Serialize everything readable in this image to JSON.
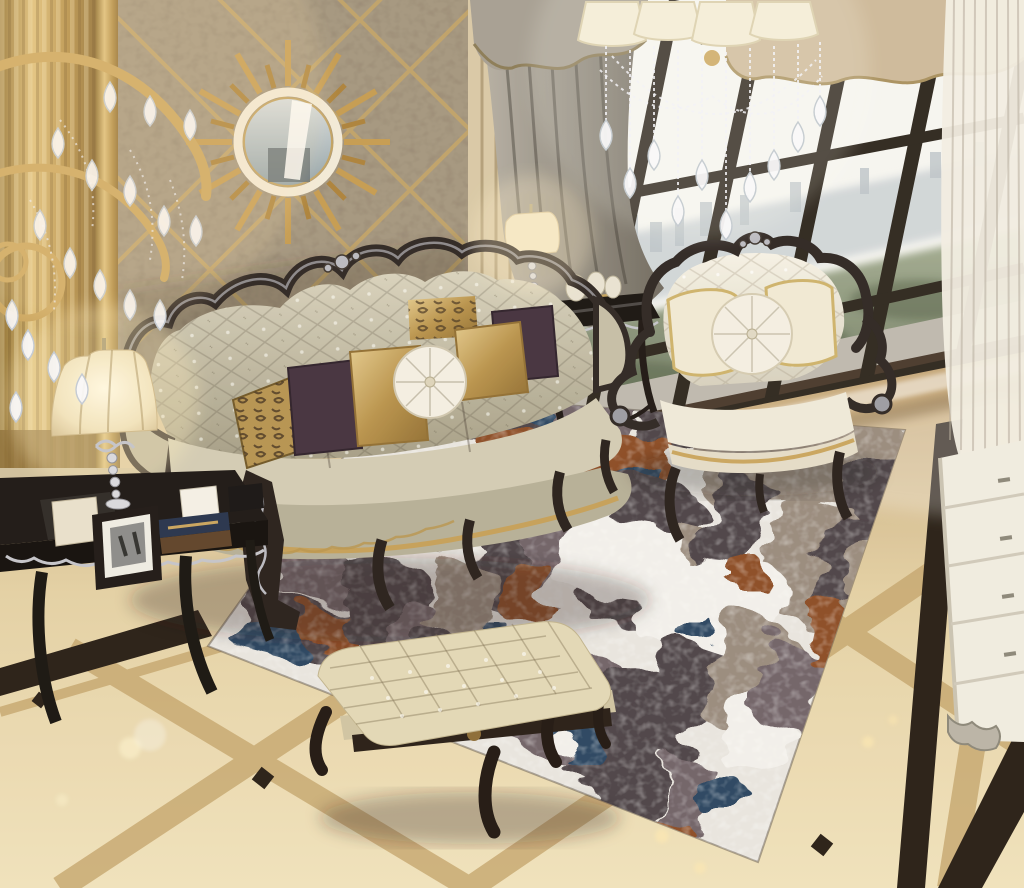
{
  "meta": {
    "description": "Luxury European-style living room photo: tufted champagne leather sofa, crystal chandeliers, sunburst mirror on mirrored marble wall, abstract distressed rug, tufted ottoman, floor-to-ceiling windows over a hazy city view, polished cream marble floor with dark inlay bands",
    "image_type": "photograph"
  },
  "palette": {
    "sky": "#f6f6f2",
    "city_haze": "#d0d6d9",
    "tree_green": "#76816a",
    "window_frame": "#2b241c",
    "wall_gold": "#c6a05c",
    "wall_marble": "#a3957e",
    "wall_cream": "#d8c8a6",
    "gold_trim": "#b4924e",
    "curtain_taupe": "#a59e92",
    "curtain_sheer": "#efece3",
    "valance_beige": "#cdb99a",
    "sofa_leather_light": "#d2cbb4",
    "chair_fabric": "#efe9da",
    "pillow_plum": "#412e3c",
    "pillow_gold": "#c7a25c",
    "pillow_white": "#f4efe3",
    "rug_base": "#e8e5e0",
    "rug_dark": "#4a3f44",
    "rug_rust": "#8a4a22",
    "rug_navy": "#27425e",
    "rug_taupe": "#97897c",
    "floor_cream": "#e2cfa2",
    "floor_band": "#c4a46c",
    "floor_black": "#241b12",
    "skirt_marble": "#46362a",
    "ottoman_leather": "#e2d7b6",
    "lamp_shade": "#f2e6c6",
    "cabinet_white": "#f0ece1",
    "silver": "#c3c3ca",
    "frame_dark": "#2b2320"
  },
  "scene": {
    "objects": [
      {
        "id": "chandelier-left",
        "label": "gold crystal chandelier arm with teardrop crystals"
      },
      {
        "id": "chandelier-center",
        "label": "crystal chandelier with cream shades"
      },
      {
        "id": "sunburst-mirror",
        "label": "gold sunburst wall mirror"
      },
      {
        "id": "lattice-wall",
        "label": "marble wall panel with gold diamond lattice"
      },
      {
        "id": "sofa",
        "label": "champagne tufted leather sofa with carved dark frame"
      },
      {
        "id": "armchair",
        "label": "cream tufted armchair with carved frame"
      },
      {
        "id": "ottoman",
        "label": "tufted leather bench ottoman"
      },
      {
        "id": "rug",
        "label": "abstract distressed area rug in white, charcoal, rust and navy"
      },
      {
        "id": "side-table",
        "label": "dark lacquered side table with frames and boxes"
      },
      {
        "id": "table-lamp",
        "label": "cream bell-shade table lamp"
      },
      {
        "id": "window-lamp",
        "label": "small cream table lamp by window"
      },
      {
        "id": "console-table",
        "label": "black console table with ornaments"
      },
      {
        "id": "windows",
        "label": "floor-to-ceiling windows with city view"
      },
      {
        "id": "curtains",
        "label": "taupe drapes, beige valance and sheer curtain"
      },
      {
        "id": "floor",
        "label": "polished cream marble floor with tan and black inlays"
      },
      {
        "id": "cabinet",
        "label": "white drawer cabinet at right"
      }
    ]
  }
}
